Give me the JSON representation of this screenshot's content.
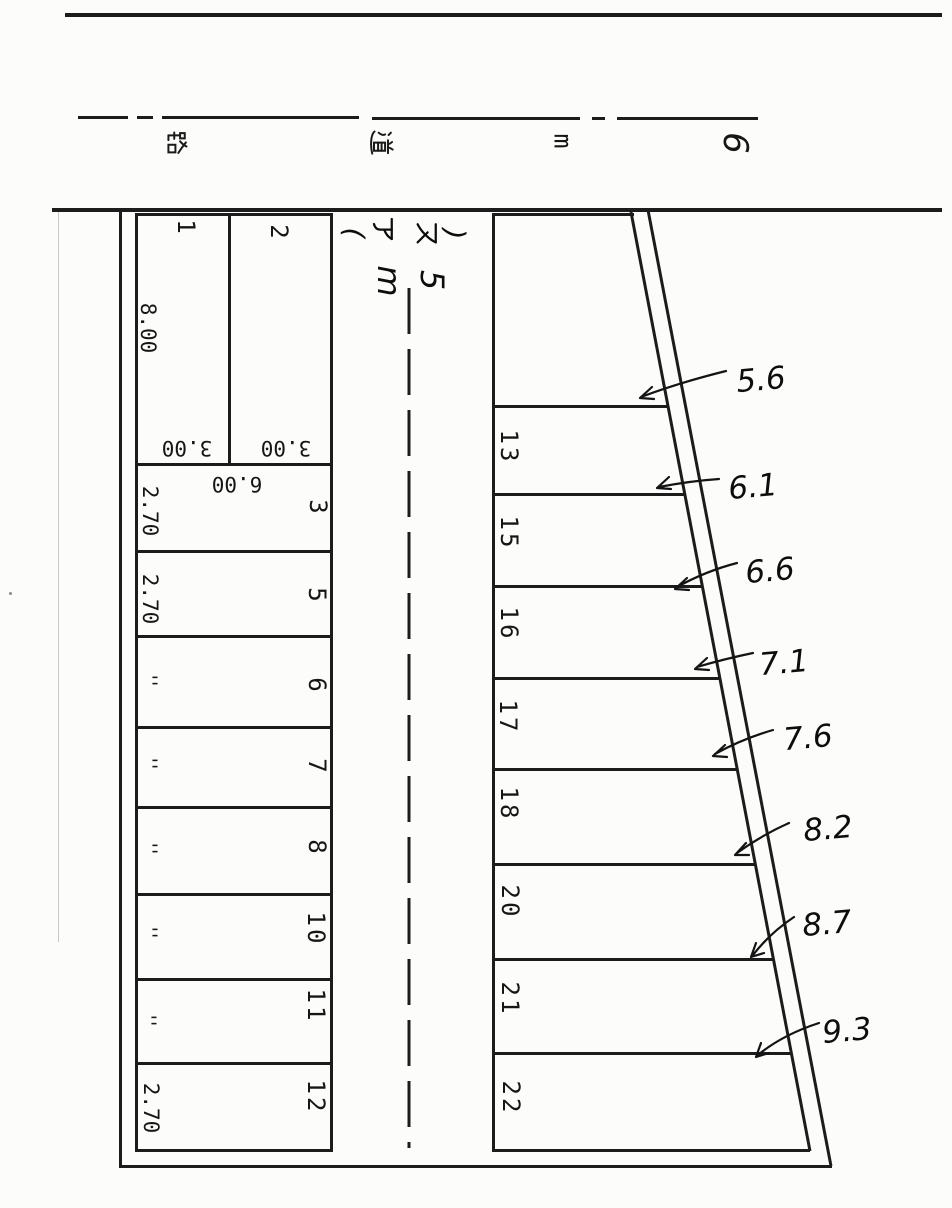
{
  "document": {
    "type_note": "scanned parking lot plot plan, text rotated 90deg",
    "ink_color": "#1c1c1c",
    "paper_color": "#fcfcfa"
  },
  "road": {
    "reading": "6m道路",
    "chars": [
      {
        "char": "路"
      },
      {
        "char": "道"
      },
      {
        "char": "m"
      },
      {
        "char": "6"
      }
    ]
  },
  "driveway": {
    "surface_open": "(",
    "surface_a": "ア",
    "surface_su": "ス",
    "surface_close": ")",
    "width_value": "5",
    "width_unit": "m"
  },
  "left_block": {
    "depth_label": "8.00",
    "inner_width_label": "6.00",
    "spaces_top": [
      {
        "number": "1",
        "width_label": "3.00"
      },
      {
        "number": "2",
        "width_label": "3.00"
      }
    ],
    "rows": [
      {
        "number": "3",
        "depth_label": "2.70"
      },
      {
        "number": "5",
        "depth_label": "2.70"
      },
      {
        "number": "6",
        "depth_label": "''"
      },
      {
        "number": "7",
        "depth_label": "''"
      },
      {
        "number": "8",
        "depth_label": "''"
      },
      {
        "number": "10",
        "depth_label": "''"
      },
      {
        "number": "11",
        "depth_label": "''"
      },
      {
        "number": "12",
        "depth_label": "2.70"
      }
    ]
  },
  "right_block": {
    "rows": [
      {
        "number": "13"
      },
      {
        "number": "15"
      },
      {
        "number": "16"
      },
      {
        "number": "17"
      },
      {
        "number": "18"
      },
      {
        "number": "20"
      },
      {
        "number": "21"
      },
      {
        "number": "22"
      }
    ],
    "depth_annotations": [
      {
        "value": "5.6"
      },
      {
        "value": "6.1"
      },
      {
        "value": "6.6"
      },
      {
        "value": "7.1"
      },
      {
        "value": "7.6"
      },
      {
        "value": "8.2"
      },
      {
        "value": "8.7"
      },
      {
        "value": "9.3"
      }
    ]
  }
}
